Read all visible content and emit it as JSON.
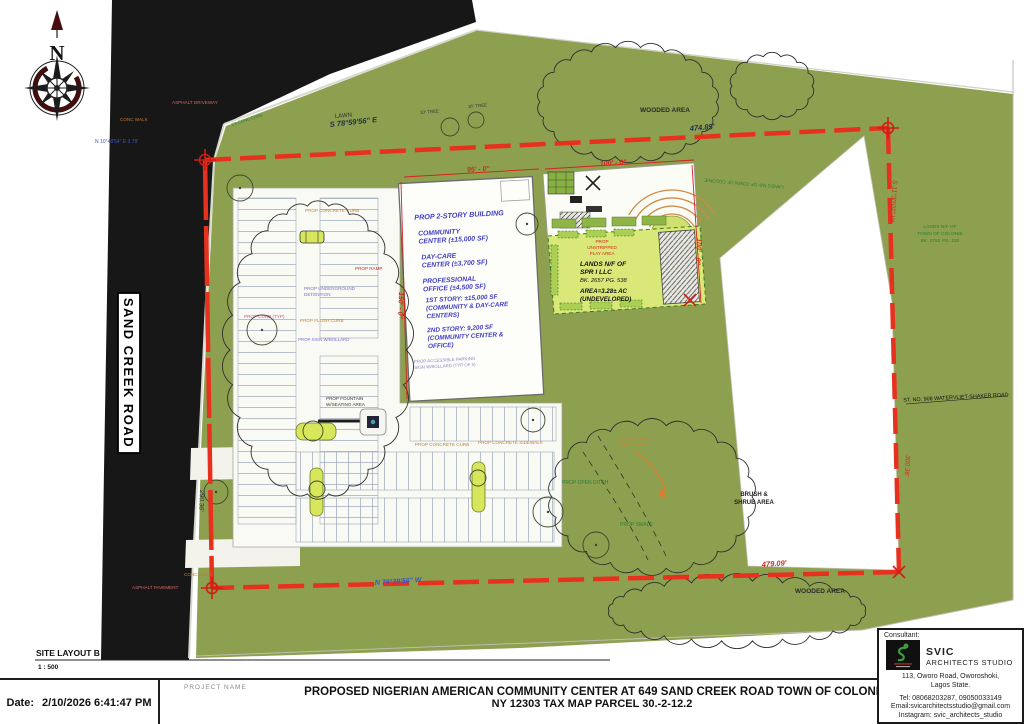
{
  "sheet": {
    "scale_block": {
      "layout_name": "SITE LAYOUT B",
      "scale": "1 : 500"
    },
    "title_block": {
      "date_label": "Date:",
      "date_value": "2/10/2026 6:41:47 PM",
      "project_name_label": "PROJECT NAME",
      "title_line1": "PROPOSED NIGERIAN AMERICAN COMMUNITY CENTER AT 649 SAND CREEK ROAD TOWN OF COLONIE,",
      "title_line2": "NY 12303 TAX MAP PARCEL 30.-2-12.2"
    },
    "consultant": {
      "label": "Consultant:",
      "firm_name": "SVIC",
      "firm_subname": "ARCHITECTS STUDIO",
      "address1": "113, Oworo Road, Oworoshoki,",
      "address2": "Lagos State.",
      "tel": "Tel: 08068203287, 09050033149",
      "email": "Email:svicarchitectsstudio@gmail.com",
      "instagram": "Instagram: svic_architects_studio"
    }
  },
  "plan": {
    "north": "N",
    "road_name": "SAND CREEK ROAD",
    "building": {
      "lines": [
        "PROP 2-STORY BUILDING",
        "COMMUNITY",
        "CENTER (±15,000 SF)",
        "DAY-CARE",
        "CENTER (±3,700 SF)",
        "PROFESSIONAL",
        "OFFICE (±4,500 SF)",
        "1ST STORY: ±15,000 SF",
        "(COMMUNITY & DAY-CARE",
        "CENTERS)",
        "2ND STORY: 9,200 SF",
        "(COMMUNITY CENTER &",
        "OFFICE)"
      ],
      "note1": "PROP ACCESSIBLE PARKING",
      "note2": "SIGN W/BOLLARD (TYP OF 5)"
    },
    "parcel": {
      "p1": "PROP",
      "p2": "UNSTRIPPED",
      "p3": "PLAY AREA",
      "owner1": "LANDS N/F OF",
      "owner2": "SPR I LLC",
      "book": "BK. 2657 PG. 538",
      "area": "AREA=3.28± AC",
      "status": "(UNDEVELOPED)"
    },
    "dims": {
      "bldg_w": "95' - 0\"",
      "bldg_d": "150' - 0\"",
      "play_w": "100' - 0\"",
      "play_d": "100' - 0\""
    },
    "boundary": {
      "bearing_top": "S 78°59'56\" E",
      "dist_top": "474.85'",
      "bearing_bottom": "N 78°39'56\" W",
      "dist_bottom": "479.09'",
      "dist_left": "290.36'",
      "dist_right": "300.36'",
      "bearing_right": "S 11°30'02\" W",
      "jog": "N 10°48'54\" E 3.78'"
    },
    "labels": {
      "lawn": "LAWN",
      "wooded_top": "WOODED AREA",
      "wooded_bottom": "WOODED AREA",
      "brush1": "BRUSH &",
      "brush2": "SHRUB AREA",
      "shaker_road": "ST. NO. 908 WATERVLIET-SHAKER ROAD",
      "asphalt_driveway": "ASPHALT DRIVEWAY",
      "asphalt_pavement": "ASPHALT PAVEMENT",
      "conc_walk_top": "CONC WALK",
      "conc_walk_bottom": "CONC WALK",
      "ex_curb": "EX CONC CURB",
      "tree10": "10\" TREE",
      "tree16": "16\" TREE",
      "prop_conc_curb1": "PROP CONCRETE CURB",
      "prop_conc_curb2": "PROP CONCRETE CURB",
      "prop_sidewalk": "PROP CONCRETE SIDEWALK",
      "fountain1": "PROP FOUNTAIN",
      "fountain2": "W/SEATING AREA",
      "detention1": "PROP UNDERGROUND",
      "detention2": "DETENTION",
      "prop_ramp": "PROP RAMP",
      "prop_curb_typ": "PROP CURB (TYP)",
      "prop_flush_curb": "PROP FLUSH CURB",
      "prop_sign_bollard": "PROP SIGN W/BOLLARD",
      "prop_swale": "PROP SWALE",
      "prop_ditch": "PROP OPEN DITCH",
      "connect1": "PROP CONNECT TO",
      "connect2": "EXIST SWALE",
      "lands_town1": "LANDS N/F OF",
      "lands_town2": "TOWN OF COLONIE",
      "lands_town3": "BK. 2792 PG. 220",
      "lands_town_top": "LANDS N/F OF TOWN OF COLONIE"
    }
  },
  "colors": {
    "site_green": "#8ca050",
    "parcel_lime": "#d9e878",
    "boundary_red": "#e8301e",
    "building_text": "#4340c4",
    "road_black": "#171717"
  }
}
